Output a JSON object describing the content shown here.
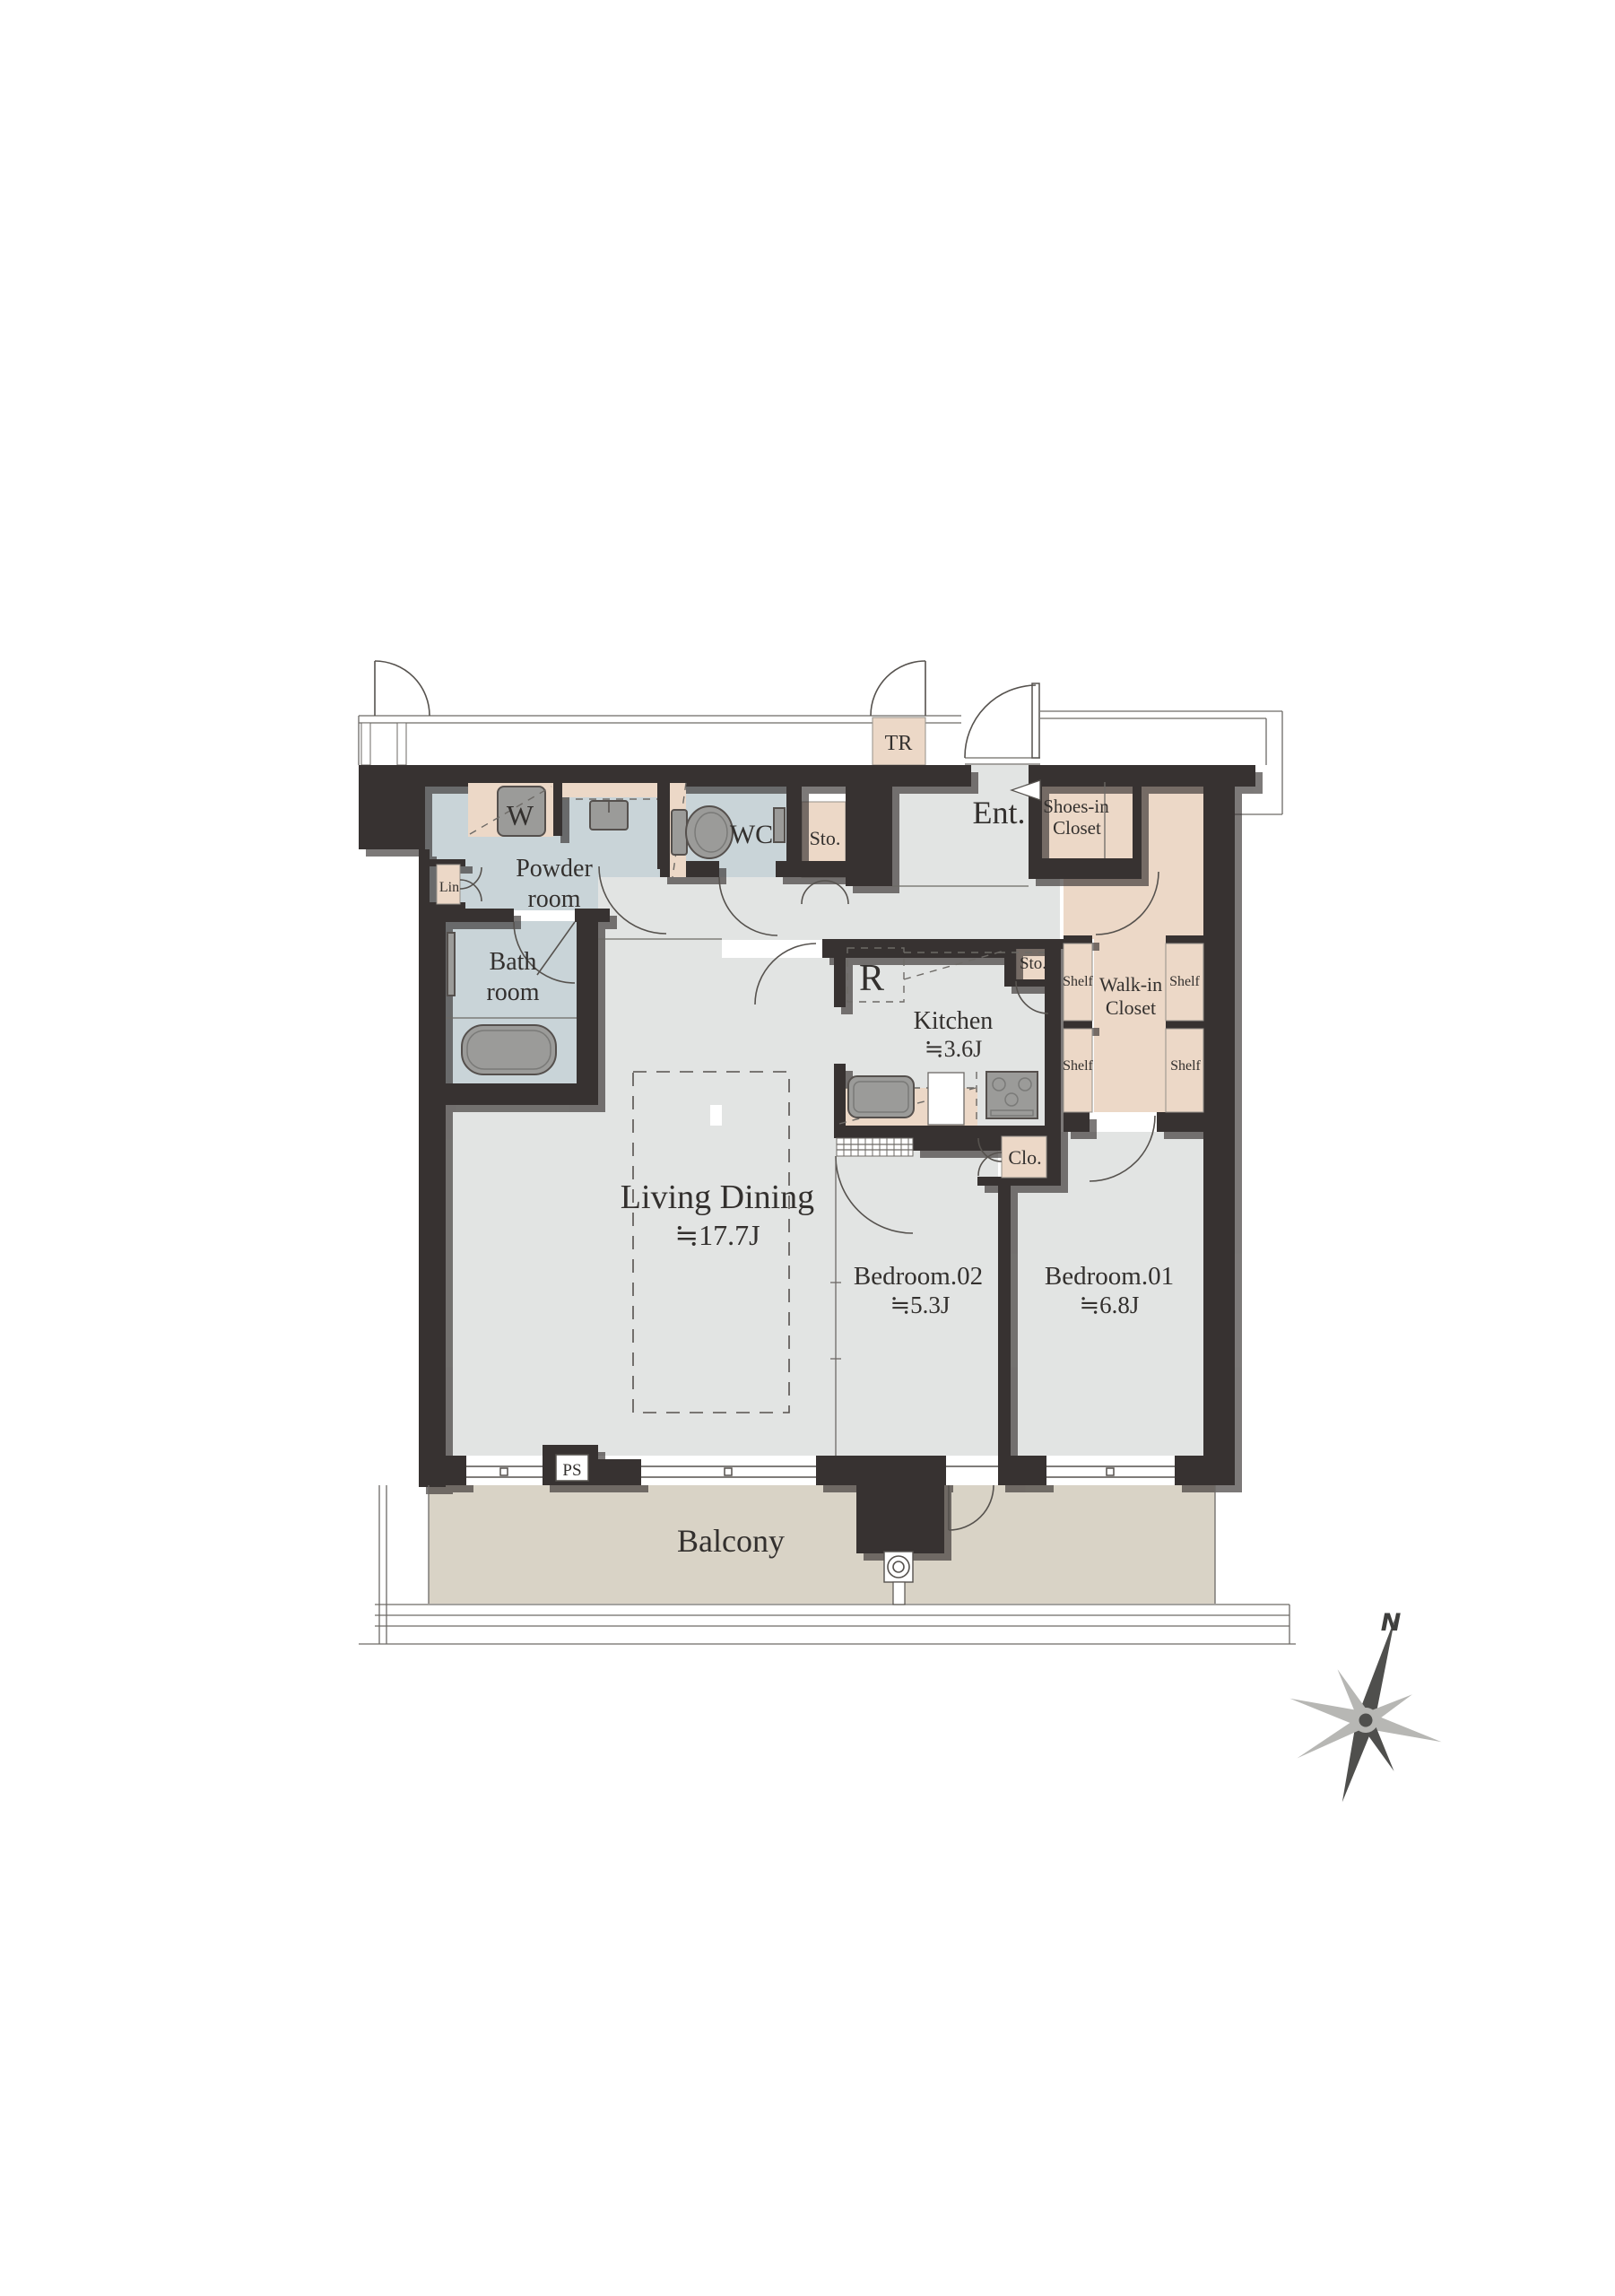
{
  "document": {
    "type": "apartment-floor-plan"
  },
  "palette": {
    "wall": "#373231",
    "wall_shadow": "#bdbdb7",
    "wet_room": "#c9d4d8",
    "closet": "#ecd8c7",
    "floor": "#e2e4e3",
    "balcony": "#d9d3c6",
    "fixture": "#9b9b99",
    "line": "#55504d"
  },
  "rooms": {
    "living_dining": {
      "name": "Living Dining",
      "area": "≒17.7J"
    },
    "kitchen": {
      "name": "Kitchen",
      "area": "≒3.6J"
    },
    "bedroom_01": {
      "name": "Bedroom.01",
      "area": "≒6.8J"
    },
    "bedroom_02": {
      "name": "Bedroom.02",
      "area": "≒5.3J"
    },
    "powder_room": [
      "Powder",
      "room"
    ],
    "bath_room": [
      "Bath",
      "room"
    ],
    "wc": "WC",
    "entrance": "Ent.",
    "balcony": "Balcony",
    "walk_in_closet": [
      "Walk-in",
      "Closet"
    ],
    "shoes_in_closet": [
      "Shoes-in",
      "Closet"
    ]
  },
  "fixtures": {
    "washer": "W",
    "refrigerator": "R",
    "linen": "Lin",
    "storage_hall": "Sto.",
    "storage_kitchen": "Sto.",
    "closet": "Clo.",
    "trunk_room": "TR",
    "pipe_space": "PS",
    "shelf": "Shelf"
  },
  "compass": {
    "north": "N"
  }
}
